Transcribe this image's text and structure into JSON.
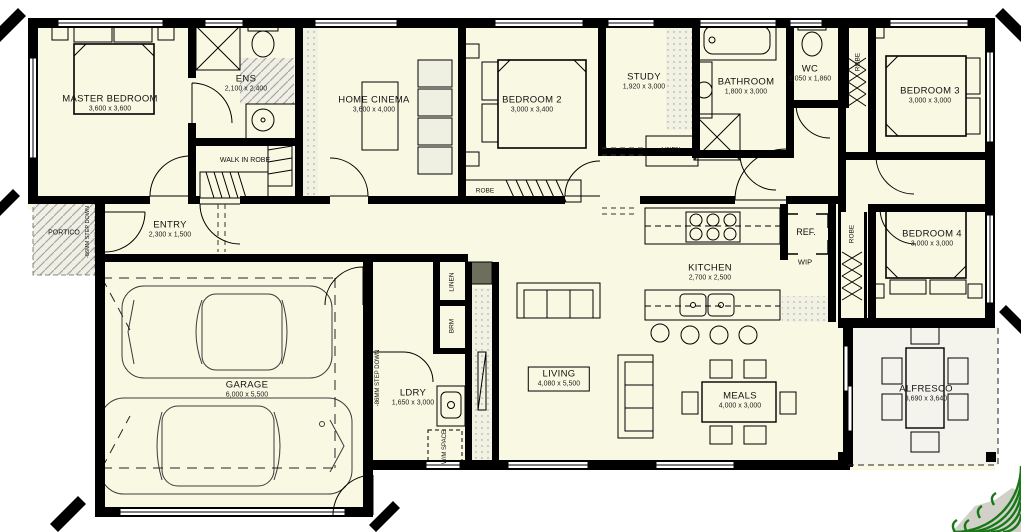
{
  "plan": {
    "rooms": {
      "master_bedroom": {
        "name": "MASTER BEDROOM",
        "dims": "3,600 x 3,600"
      },
      "ens": {
        "name": "ENS",
        "dims": "2,100 x 2,400"
      },
      "walk_in_robe": {
        "name": "WALK IN ROBE"
      },
      "home_cinema": {
        "name": "HOME CINEMA",
        "dims": "3,600 x 4,000"
      },
      "bedroom2": {
        "name": "BEDROOM 2",
        "dims": "3,000 x 3,400"
      },
      "study": {
        "name": "STUDY",
        "dims": "1,920 x 3,000"
      },
      "bathroom": {
        "name": "BATHROOM",
        "dims": "1,800 x 3,000"
      },
      "wc": {
        "name": "WC",
        "dims": "1,050 x 1,860"
      },
      "bedroom3": {
        "name": "BEDROOM 3",
        "dims": "3,000 x 3,000"
      },
      "bedroom4": {
        "name": "BEDROOM 4",
        "dims": "3,000 x 3,000"
      },
      "kitchen": {
        "name": "KITCHEN",
        "dims": "2,700 x 2,500"
      },
      "entry": {
        "name": "ENTRY",
        "dims": "2,300 x 1,500"
      },
      "garage": {
        "name": "GARAGE",
        "dims": "6,000 x 5,500"
      },
      "ldry": {
        "name": "LDRY",
        "dims": "1,650 x 3,000"
      },
      "living": {
        "name": "LIVING",
        "dims": "4,080 x 5,500"
      },
      "meals": {
        "name": "MEALS",
        "dims": "4,000 x 3,000"
      },
      "alfresco": {
        "name": "ALFRESCO",
        "dims": "3,690 x 3,640"
      },
      "portico": {
        "name": "PORTICO"
      }
    },
    "annotations": {
      "robe_bedroom2": "ROBE",
      "robe_bedroom3": "ROBE",
      "robe_bedroom4": "ROBE",
      "linen_hall": "LINEN",
      "linen_cupboard": "LINEN",
      "brm": "BRM",
      "ref": "REF.",
      "wip": "WIP",
      "wm_space": "W/M SPACE",
      "step_down_garage": "-86MM STEP DOWN",
      "step_down_portico": "-86MM STEP DOWN"
    },
    "colors": {
      "paper": "#FFFFFF",
      "floor": "#F9F9E3",
      "wall": "#000000",
      "alfresco_floor": "#F4F4EC",
      "portico_floor": "#EFEFE7",
      "logo_green": "#187818"
    }
  }
}
